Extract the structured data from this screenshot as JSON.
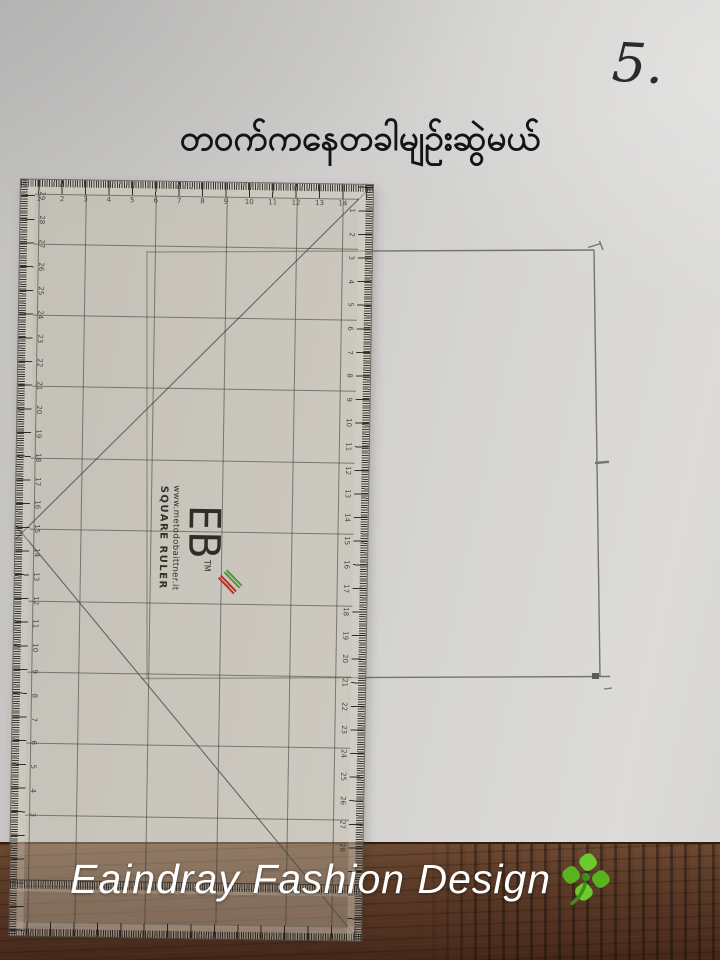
{
  "page": {
    "step_number": "5.",
    "title": "တဝက်ကနေတခါမျဉ်းဆွဲမယ်",
    "watermark": {
      "text": "Eaindray Fashion Design",
      "icon": "four-leaf-clover"
    }
  },
  "ruler": {
    "product_label": "SQUARE RULER",
    "brand_website": "www.metodobaittner.it",
    "monogram": "EB",
    "trademark": "TM",
    "top_scale_numbers": [
      1,
      2,
      3,
      4,
      5,
      6,
      7,
      8,
      9,
      10,
      11,
      12,
      13,
      14
    ],
    "left_scale_numbers": [
      29,
      28,
      27,
      26,
      25,
      24,
      23,
      22,
      21,
      20,
      19,
      18,
      17,
      16,
      15,
      14,
      13,
      12,
      11,
      10,
      9,
      8,
      7,
      6,
      5,
      4,
      3
    ],
    "right_scale_numbers": [
      1,
      2,
      3,
      4,
      5,
      6,
      7,
      8,
      9,
      10,
      11,
      12,
      13,
      14,
      15,
      16,
      17,
      18,
      19,
      20,
      21,
      22,
      23,
      24,
      25,
      26,
      27,
      28
    ]
  },
  "pencil_drawing": {
    "shape": "rectangle-outline",
    "marks": [
      "half-point tick on right edge",
      "small hook mark at top-right corner"
    ]
  },
  "colors": {
    "paper": "#d3d2cf",
    "wood": "#5a3926",
    "pencil_line": "#6f6e68",
    "ruler_print": "#3c3a34",
    "stripe_green": "#4a9c3d",
    "stripe_red": "#b5322e",
    "watermark_text": "#ffffff",
    "clover_green": "#5bbf2a"
  }
}
